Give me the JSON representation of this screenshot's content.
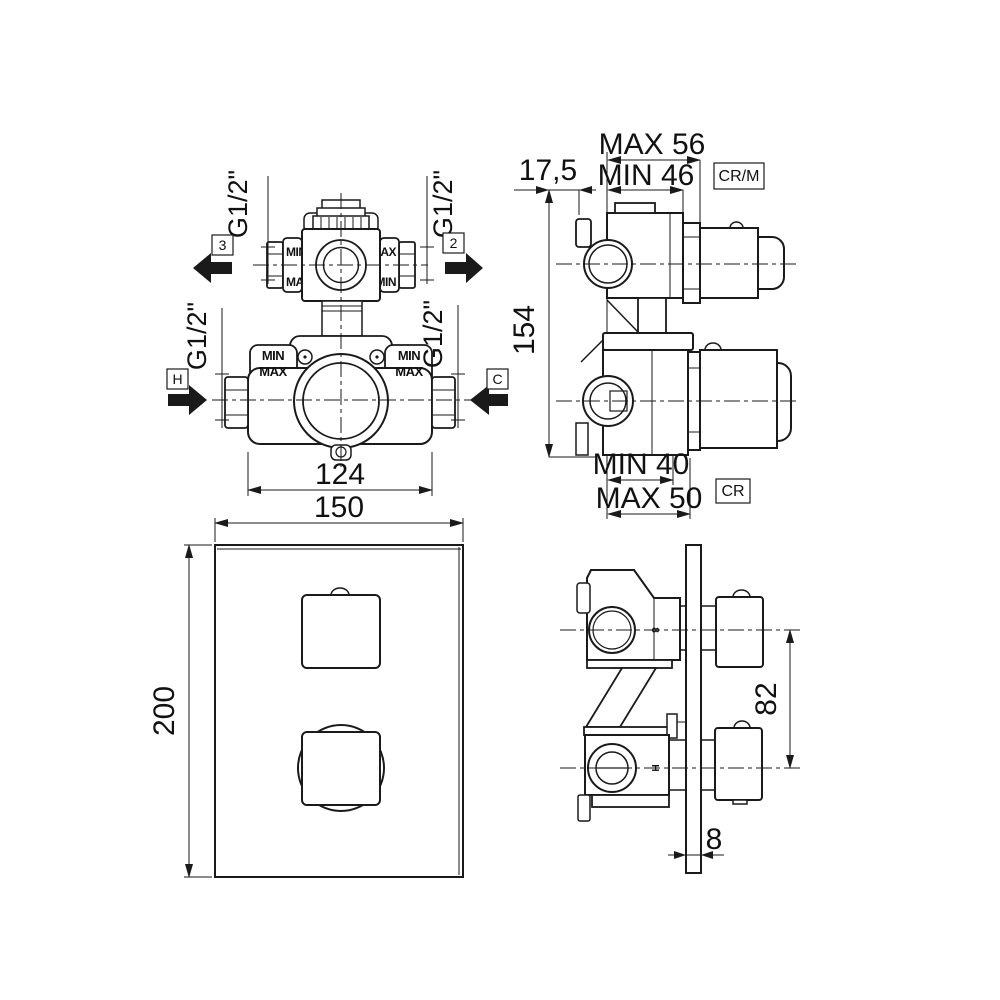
{
  "drawing": {
    "type": "technical-drawing",
    "subject": "concealed thermostatic shower mixer valve, 4 views (valve front, valve side, trim plate front, installed side)",
    "line_color": "#1a1a1a",
    "background": "#ffffff"
  },
  "labels": {
    "outlet_left": "3",
    "outlet_right": "2",
    "inlet_hot": "H",
    "inlet_cold": "C",
    "thread": "G1/2\"",
    "min": "MIN",
    "max": "MAX",
    "finish_top": "CR/M",
    "finish_bottom": "CR",
    "cartridge_mark_top": "8",
    "cartridge_mark_bottom": "H"
  },
  "dims": {
    "valve_width": "124",
    "plate_width": "150",
    "plate_height": "200",
    "rough_in_height": "154",
    "wall_offset": "17,5",
    "top_depth_max": "MAX 56",
    "top_depth_min": "MIN 46",
    "bottom_depth_min": "MIN 40",
    "bottom_depth_max": "MAX 50",
    "handle_distance": "82",
    "plate_thickness": "8"
  }
}
